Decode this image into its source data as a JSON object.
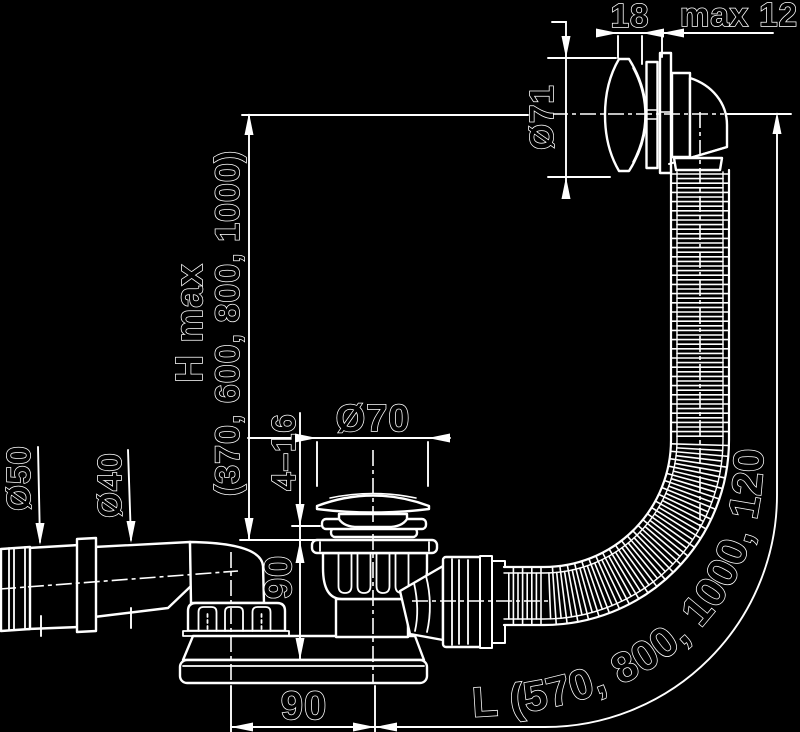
{
  "drawing": {
    "type": "technical-drawing",
    "subject": "bathtub-waste-overflow-siphon",
    "background_color": "#000000",
    "line_color": "#ffffff"
  },
  "dimensions": {
    "cap_offset": "18",
    "wall_thickness_max": "max 12",
    "overflow_cap_diameter": "Ø71",
    "height_label": "H max",
    "height_values": "(370, 600, 800, 1000)",
    "outlet_pipe_diameter": "Ø50",
    "inlet_pipe_diameter": "Ø40",
    "plug_diameter": "Ø70",
    "clamp_range": "4–16",
    "body_height": "90",
    "inlet_offset": "90",
    "hose_length": "L (570, 800, 1000, 1200)"
  }
}
